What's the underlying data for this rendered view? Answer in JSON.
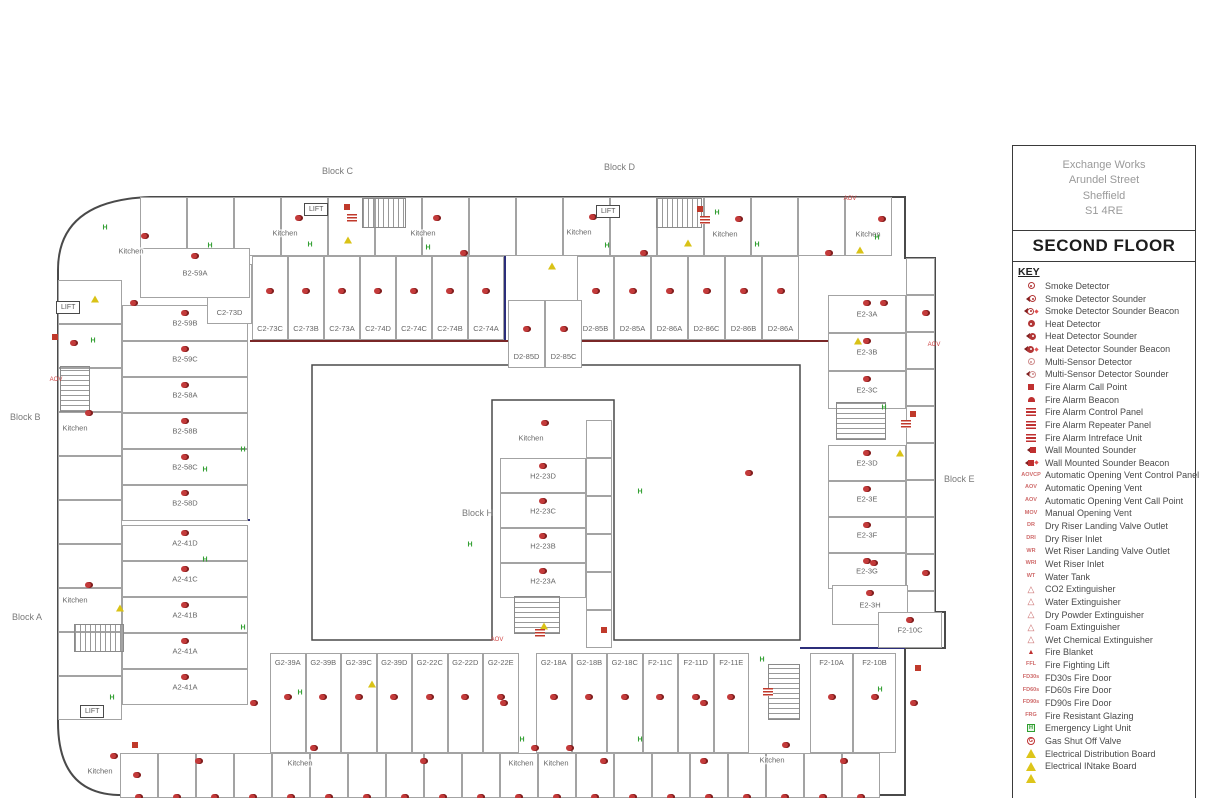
{
  "title_block": {
    "address_lines": [
      "Exchange Works",
      "Arundel Street",
      "Sheffield",
      "S1 4RE"
    ],
    "floor": "SECOND FLOOR",
    "key_heading": "KEY"
  },
  "legend": {
    "items": [
      {
        "icon": "smoke",
        "label": "Smoke Detector"
      },
      {
        "icon": "smoke-sounder",
        "label": "Smoke Detector Sounder"
      },
      {
        "icon": "smoke-sounder-beacon",
        "label": "Smoke Detector Sounder Beacon"
      },
      {
        "icon": "heat",
        "label": "Heat Detector"
      },
      {
        "icon": "heat-sounder",
        "label": "Heat Detector Sounder"
      },
      {
        "icon": "heat-sounder-beacon",
        "label": "Heat Detector Sounder Beacon"
      },
      {
        "icon": "multi",
        "label": "Multi-Sensor Detector"
      },
      {
        "icon": "multi-sounder",
        "label": "Multi-Sensor Detector Sounder"
      },
      {
        "icon": "call-point",
        "label": "Fire Alarm Call Point"
      },
      {
        "icon": "beacon",
        "label": "Fire Alarm Beacon"
      },
      {
        "icon": "panel",
        "label": "Fire Alarm Control Panel"
      },
      {
        "icon": "panel",
        "label": "Fire Alarm Repeater Panel"
      },
      {
        "icon": "panel",
        "label": "Fire Alarm Intreface Unit"
      },
      {
        "icon": "wall-sounder",
        "label": "Wall Mounted Sounder"
      },
      {
        "icon": "wall-sounder-beacon",
        "label": "Wall Mounted Sounder Beacon"
      },
      {
        "icon": "text",
        "icon_text": "AOVCP",
        "label": "Automatic Opening Vent Control Panel"
      },
      {
        "icon": "text",
        "icon_text": "AOV",
        "label": "Automatic Opening Vent"
      },
      {
        "icon": "text",
        "icon_text": "AOV",
        "label": "Automatic Opening Vent Call Point"
      },
      {
        "icon": "text",
        "icon_text": "MOV",
        "label": "Manual Opening Vent"
      },
      {
        "icon": "text",
        "icon_text": "DR",
        "label": "Dry Riser Landing Valve Outlet"
      },
      {
        "icon": "text",
        "icon_text": "DRI",
        "label": "Dry Riser Inlet"
      },
      {
        "icon": "text",
        "icon_text": "WR",
        "label": "Wet Riser Landing Valve Outlet"
      },
      {
        "icon": "text",
        "icon_text": "WRI",
        "label": "Wet Riser Inlet"
      },
      {
        "icon": "text",
        "icon_text": "WT",
        "label": "Water Tank"
      },
      {
        "icon": "ext",
        "label": "CO2 Extinguisher"
      },
      {
        "icon": "ext",
        "label": "Water Extinguisher"
      },
      {
        "icon": "ext",
        "label": "Dry Powder Extinguisher"
      },
      {
        "icon": "ext",
        "label": "Foam Extinguisher"
      },
      {
        "icon": "ext",
        "label": "Wet Chemical Extinguisher"
      },
      {
        "icon": "blanket",
        "label": "Fire Blanket"
      },
      {
        "icon": "text",
        "icon_text": "FFL",
        "label": "Fire Fighting Lift"
      },
      {
        "icon": "text",
        "icon_text": "FD30s",
        "label": "FD30s Fire Door"
      },
      {
        "icon": "text",
        "icon_text": "FD60s",
        "label": "FD60s Fire Door"
      },
      {
        "icon": "text",
        "icon_text": "FD90s",
        "label": "FD90s Fire Door"
      },
      {
        "icon": "text",
        "icon_text": "FRG",
        "label": "Fire Resistant Glazing"
      },
      {
        "icon": "emergency-light",
        "label": "Emergency Light Unit"
      },
      {
        "icon": "gas",
        "label": "Gas Shut Off Valve"
      },
      {
        "icon": "electrical",
        "label": "Electrical Distribution Board"
      },
      {
        "icon": "electrical",
        "label": "Electrical INtake Board"
      },
      {
        "icon": "electrical",
        "label": ""
      }
    ]
  },
  "plan": {
    "palette": {
      "wall": "#4a4a4a",
      "navy": "#2c2e7a",
      "maroon": "#7a2727",
      "red": "#c0392b",
      "green": "#2f9e2f",
      "yellow": "#d9c216"
    },
    "kitchen_label": "Kitchen",
    "lift_label": "LIFT",
    "block_labels": [
      {
        "text": "Block B",
        "x": 10,
        "y": 412
      },
      {
        "text": "Block A",
        "x": 12,
        "y": 612
      },
      {
        "text": "Block C",
        "x": 322,
        "y": 166
      },
      {
        "text": "Block D",
        "x": 604,
        "y": 162
      },
      {
        "text": "Block E",
        "x": 944,
        "y": 474
      },
      {
        "text": "Block H",
        "x": 462,
        "y": 508
      }
    ],
    "kitchens": [
      {
        "x": 131,
        "y": 251
      },
      {
        "x": 285,
        "y": 233
      },
      {
        "x": 423,
        "y": 233
      },
      {
        "x": 579,
        "y": 232
      },
      {
        "x": 725,
        "y": 234
      },
      {
        "x": 868,
        "y": 234
      },
      {
        "x": 75,
        "y": 428
      },
      {
        "x": 75,
        "y": 600
      },
      {
        "x": 531,
        "y": 438
      },
      {
        "x": 100,
        "y": 771
      },
      {
        "x": 300,
        "y": 763
      },
      {
        "x": 521,
        "y": 763
      },
      {
        "x": 556,
        "y": 763
      },
      {
        "x": 772,
        "y": 760
      }
    ],
    "lifts": [
      {
        "x": 304,
        "y": 203
      },
      {
        "x": 596,
        "y": 205
      },
      {
        "x": 80,
        "y": 705
      },
      {
        "x": 56,
        "y": 301
      }
    ],
    "room_groups": [
      {
        "name": "block-c-row",
        "dir": "h",
        "x": 252,
        "y": 256,
        "w": 36,
        "h": 84,
        "lpos": "bottom",
        "det": true,
        "rooms": [
          "C2-73C",
          "C2-73B",
          "C2-73A",
          "C2-74D",
          "C2-74C",
          "C2-74B",
          "C2-74A"
        ]
      },
      {
        "name": "block-d-row",
        "dir": "h",
        "x": 577,
        "y": 256,
        "w": 37,
        "h": 84,
        "lpos": "bottom",
        "det": true,
        "rooms": [
          "D2-85B",
          "D2-85A",
          "D2-86A",
          "D2-86C",
          "D2-86B",
          "D2-86A"
        ]
      },
      {
        "name": "block-b-col",
        "dir": "v",
        "x": 122,
        "y": 305,
        "w": 126,
        "h": 36,
        "lpos": "center",
        "det": true,
        "rooms": [
          "B2-59B",
          "B2-59C",
          "B2-58A",
          "B2-58B",
          "B2-58C",
          "B2-58D"
        ]
      },
      {
        "name": "block-a-col",
        "dir": "v",
        "x": 122,
        "y": 525,
        "w": 126,
        "h": 36,
        "lpos": "center",
        "det": true,
        "rooms": [
          "A2-41D",
          "A2-41C",
          "A2-41B",
          "A2-41A",
          "A2-41A"
        ]
      },
      {
        "name": "block-e-top",
        "dir": "v",
        "x": 828,
        "y": 295,
        "w": 78,
        "h": 38,
        "lpos": "center",
        "det": true,
        "rooms": [
          "E2-3A",
          "E2-3B",
          "E2-3C"
        ]
      },
      {
        "name": "block-e-mid",
        "dir": "v",
        "x": 828,
        "y": 445,
        "w": 78,
        "h": 36,
        "lpos": "center",
        "det": true,
        "rooms": [
          "E2-3D",
          "E2-3E",
          "E2-3F",
          "E2-3G"
        ]
      },
      {
        "name": "block-h-col",
        "dir": "v",
        "x": 500,
        "y": 458,
        "w": 86,
        "h": 35,
        "lpos": "center",
        "det": true,
        "rooms": [
          "H2-23D",
          "H2-23C",
          "H2-23B",
          "H2-23A"
        ]
      },
      {
        "name": "block-g-row",
        "dir": "h",
        "x": 270,
        "y": 653,
        "w": 35.5,
        "h": 100,
        "lpos": "top",
        "det": true,
        "rooms": [
          "G2-39A",
          "G2-39B",
          "G2-39C",
          "G2-39D",
          "G2-22C",
          "G2-22D",
          "G2-22E"
        ]
      },
      {
        "name": "block-gf-row",
        "dir": "h",
        "x": 536,
        "y": 653,
        "w": 35.5,
        "h": 100,
        "lpos": "top",
        "det": true,
        "rooms": [
          "G2-18A",
          "G2-18B",
          "G2-18C",
          "F2-11C",
          "F2-11D",
          "F2-11E"
        ]
      },
      {
        "name": "block-f-row",
        "dir": "h",
        "x": 810,
        "y": 653,
        "w": 43,
        "h": 100,
        "lpos": "top",
        "det": true,
        "rooms": [
          "F2-10A",
          "F2-10B"
        ]
      },
      {
        "name": "bottom-row-2",
        "dir": "h",
        "x": 120,
        "y": 753,
        "w": 38,
        "h": 45,
        "lpos": "top",
        "det": true,
        "rooms": [
          "",
          "",
          "",
          "",
          "",
          "",
          "",
          "",
          "",
          "",
          "",
          "",
          "",
          "",
          "",
          "",
          "",
          "",
          "",
          ""
        ]
      },
      {
        "name": "top-outer",
        "dir": "h",
        "x": 140,
        "y": 197,
        "w": 47,
        "h": 59,
        "lpos": "top",
        "det": false,
        "rooms": [
          "",
          "",
          "",
          "",
          "",
          "",
          "",
          "",
          "",
          "",
          "",
          "",
          "",
          "",
          "",
          ""
        ]
      },
      {
        "name": "left-outer",
        "dir": "v",
        "x": 58,
        "y": 280,
        "w": 64,
        "h": 44,
        "lpos": "center",
        "det": false,
        "rooms": [
          "",
          "",
          "",
          "",
          "",
          "",
          "",
          "",
          "",
          ""
        ]
      },
      {
        "name": "e-outer",
        "dir": "v",
        "x": 906,
        "y": 258,
        "w": 29,
        "h": 37,
        "lpos": "center",
        "det": false,
        "rooms": [
          "",
          "",
          "",
          "",
          "",
          "",
          "",
          "",
          "",
          ""
        ]
      },
      {
        "name": "h-outer",
        "dir": "v",
        "x": 586,
        "y": 420,
        "w": 26,
        "h": 38,
        "lpos": "center",
        "det": false,
        "rooms": [
          "",
          "",
          "",
          "",
          "",
          ""
        ]
      }
    ],
    "single_rooms": [
      {
        "label": "C2-73D",
        "x": 207,
        "y": 264,
        "w": 45,
        "h": 60,
        "lpos": "bottom"
      },
      {
        "label": "D2-85D",
        "x": 508,
        "y": 300,
        "w": 37,
        "h": 68,
        "lpos": "bottom"
      },
      {
        "label": "D2-85C",
        "x": 545,
        "y": 300,
        "w": 37,
        "h": 68,
        "lpos": "bottom"
      },
      {
        "label": "B2-59A",
        "x": 140,
        "y": 248,
        "w": 110,
        "h": 50,
        "lpos": "center"
      },
      {
        "label": "E2-3H",
        "x": 832,
        "y": 585,
        "w": 76,
        "h": 40,
        "lpos": "center"
      },
      {
        "label": "F2-10C",
        "x": 878,
        "y": 612,
        "w": 64,
        "h": 36,
        "lpos": "center"
      }
    ],
    "stairs": [
      {
        "x": 362,
        "y": 198,
        "w": 44,
        "h": 30,
        "dir": "h"
      },
      {
        "x": 656,
        "y": 198,
        "w": 46,
        "h": 30,
        "dir": "h"
      },
      {
        "x": 836,
        "y": 402,
        "w": 50,
        "h": 38,
        "dir": "v"
      },
      {
        "x": 514,
        "y": 596,
        "w": 46,
        "h": 38,
        "dir": "v"
      },
      {
        "x": 768,
        "y": 664,
        "w": 32,
        "h": 56,
        "dir": "v"
      },
      {
        "x": 60,
        "y": 366,
        "w": 30,
        "h": 46,
        "dir": "v"
      },
      {
        "x": 74,
        "y": 624,
        "w": 50,
        "h": 28,
        "dir": "h"
      }
    ],
    "icons": [
      {
        "t": "el",
        "x": 105,
        "y": 228
      },
      {
        "t": "el",
        "x": 210,
        "y": 246
      },
      {
        "t": "el",
        "x": 310,
        "y": 245
      },
      {
        "t": "el",
        "x": 428,
        "y": 248
      },
      {
        "t": "el",
        "x": 607,
        "y": 246
      },
      {
        "t": "el",
        "x": 717,
        "y": 213
      },
      {
        "t": "el",
        "x": 757,
        "y": 245
      },
      {
        "t": "el",
        "x": 93,
        "y": 341
      },
      {
        "t": "el",
        "x": 205,
        "y": 470
      },
      {
        "t": "el",
        "x": 243,
        "y": 450
      },
      {
        "t": "el",
        "x": 205,
        "y": 560
      },
      {
        "t": "el",
        "x": 243,
        "y": 628
      },
      {
        "t": "el",
        "x": 470,
        "y": 545
      },
      {
        "t": "el",
        "x": 640,
        "y": 492
      },
      {
        "t": "el",
        "x": 884,
        "y": 408
      },
      {
        "t": "el",
        "x": 877,
        "y": 238
      },
      {
        "t": "el",
        "x": 112,
        "y": 698
      },
      {
        "t": "el",
        "x": 300,
        "y": 693
      },
      {
        "t": "el",
        "x": 522,
        "y": 740
      },
      {
        "t": "el",
        "x": 640,
        "y": 740
      },
      {
        "t": "el",
        "x": 762,
        "y": 660
      },
      {
        "t": "el",
        "x": 880,
        "y": 690
      },
      {
        "t": "ed",
        "x": 95,
        "y": 299
      },
      {
        "t": "ed",
        "x": 348,
        "y": 240
      },
      {
        "t": "ed",
        "x": 552,
        "y": 266
      },
      {
        "t": "ed",
        "x": 688,
        "y": 243
      },
      {
        "t": "ed",
        "x": 858,
        "y": 341
      },
      {
        "t": "ed",
        "x": 900,
        "y": 453
      },
      {
        "t": "ed",
        "x": 120,
        "y": 608
      },
      {
        "t": "ed",
        "x": 372,
        "y": 684
      },
      {
        "t": "ed",
        "x": 544,
        "y": 626
      },
      {
        "t": "ed",
        "x": 860,
        "y": 250
      },
      {
        "t": "cp",
        "x": 347,
        "y": 207
      },
      {
        "t": "cp",
        "x": 700,
        "y": 209
      },
      {
        "t": "cp",
        "x": 55,
        "y": 337
      },
      {
        "t": "cp",
        "x": 913,
        "y": 414
      },
      {
        "t": "cp",
        "x": 604,
        "y": 630
      },
      {
        "t": "cp",
        "x": 135,
        "y": 745
      },
      {
        "t": "cp",
        "x": 918,
        "y": 668
      },
      {
        "t": "panel",
        "x": 352,
        "y": 218
      },
      {
        "t": "panel",
        "x": 705,
        "y": 220
      },
      {
        "t": "panel",
        "x": 906,
        "y": 424
      },
      {
        "t": "panel",
        "x": 540,
        "y": 633
      },
      {
        "t": "panel",
        "x": 768,
        "y": 692
      },
      {
        "t": "txt",
        "text": "AOV",
        "x": 934,
        "y": 345
      },
      {
        "t": "txt",
        "text": "AOV",
        "x": 56,
        "y": 380
      },
      {
        "t": "txt",
        "text": "AOV",
        "x": 497,
        "y": 640
      },
      {
        "t": "txt",
        "text": "AOV",
        "x": 850,
        "y": 199
      },
      {
        "t": "det",
        "x": 130,
        "y": 300
      },
      {
        "t": "det",
        "x": 460,
        "y": 250
      },
      {
        "t": "det",
        "x": 640,
        "y": 250
      },
      {
        "t": "det",
        "x": 825,
        "y": 250
      },
      {
        "t": "det",
        "x": 880,
        "y": 300
      },
      {
        "t": "det",
        "x": 70,
        "y": 340
      },
      {
        "t": "det",
        "x": 745,
        "y": 470
      },
      {
        "t": "det",
        "x": 250,
        "y": 700
      },
      {
        "t": "det",
        "x": 500,
        "y": 700
      },
      {
        "t": "det",
        "x": 700,
        "y": 700
      },
      {
        "t": "det",
        "x": 870,
        "y": 560
      },
      {
        "t": "det",
        "x": 910,
        "y": 700
      },
      {
        "t": "det",
        "x": 133,
        "y": 772
      },
      {
        "t": "det",
        "x": 195,
        "y": 758
      },
      {
        "t": "det",
        "x": 420,
        "y": 758
      },
      {
        "t": "det",
        "x": 600,
        "y": 758
      },
      {
        "t": "det",
        "x": 700,
        "y": 758
      },
      {
        "t": "det",
        "x": 840,
        "y": 758
      },
      {
        "t": "det",
        "x": 922,
        "y": 310
      },
      {
        "t": "det",
        "x": 922,
        "y": 570
      }
    ]
  }
}
